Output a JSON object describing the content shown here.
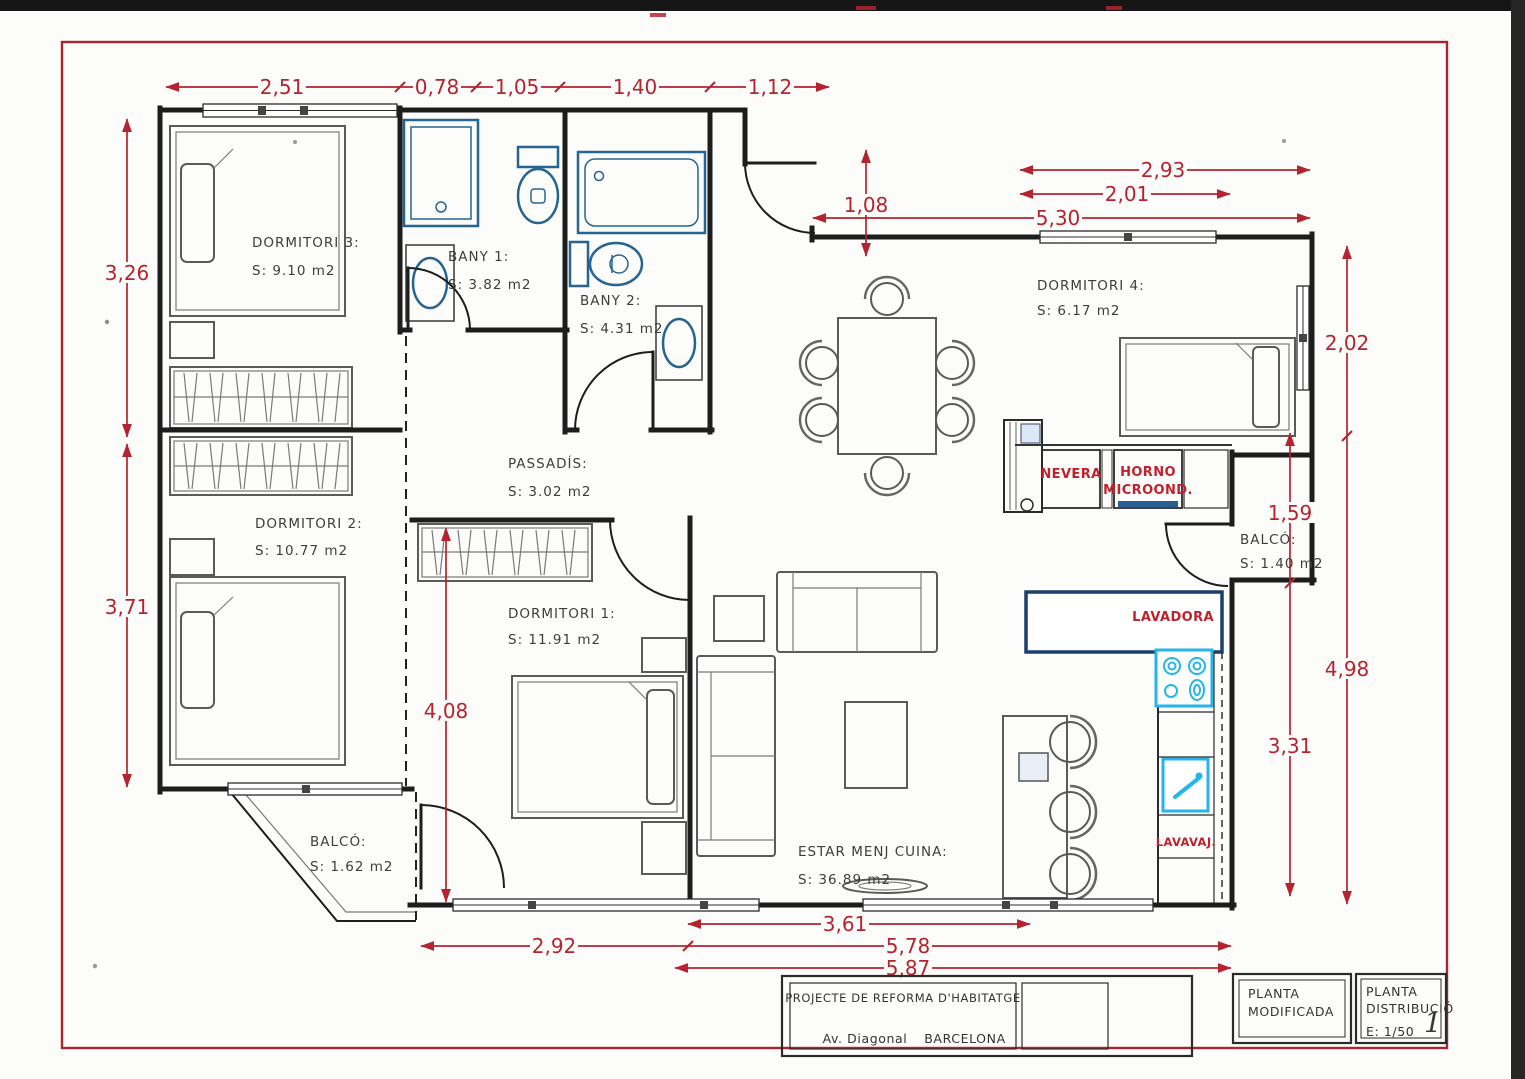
{
  "rooms": {
    "d3": {
      "name": "DORMITORI 3:",
      "area": "S: 9.10 m2"
    },
    "bany1": {
      "name": "BANY 1:",
      "area": "S: 3.82 m2"
    },
    "bany2": {
      "name": "BANY 2:",
      "area": "S: 4.31 m2"
    },
    "d4": {
      "name": "DORMITORI 4:",
      "area": "S: 6.17 m2"
    },
    "passadis": {
      "name": "PASSADÍS:",
      "area": "S: 3.02 m2"
    },
    "d2": {
      "name": "DORMITORI 2:",
      "area": "S: 10.77 m2"
    },
    "d1": {
      "name": "DORMITORI 1:",
      "area": "S: 11.91 m2"
    },
    "balco_r": {
      "name": "BALCÓ:",
      "area": "S: 1.40 m2"
    },
    "balco_l": {
      "name": "BALCÓ:",
      "area": "S: 1.62 m2"
    },
    "estar": {
      "name": "ESTAR MENJ CUINA:",
      "area": "S: 36.89 m2"
    }
  },
  "appliances": {
    "nevera": "NEVERA",
    "horno_1": "HORNO",
    "horno_2": "MICROOND.",
    "lavadora": "LAVADORA",
    "lavavaj": "LAVAVAJ."
  },
  "dims": {
    "top": [
      "2,51",
      "0,78",
      "1,05",
      "1,40",
      "1,12"
    ],
    "left": [
      "3,26",
      "3,71"
    ],
    "d1_height": "4,08",
    "entry": "1,08",
    "right_top": [
      "2,93",
      "2,01",
      "5,30"
    ],
    "right_col_a": [
      "2,02",
      "4,98"
    ],
    "right_col_b": [
      "1,59",
      "3,31"
    ],
    "bottom": [
      "3,61",
      "2,92",
      "5,78",
      "5,87"
    ]
  },
  "title_block": {
    "project": "PROJECTE  DE REFORMA D'HABITATGE",
    "street": "Av. Diagonal",
    "city": "BARCELONA",
    "sheet_type_1": "PLANTA",
    "sheet_type_2": "MODIFICADA",
    "sheet_name_1": "PLANTA",
    "sheet_name_2": "DISTRIBUCIÓ",
    "scale": "E: 1/50",
    "sheet_number": "1"
  },
  "colors": {
    "dimension_red": "#b5232e",
    "fixture_blue": "#27648f",
    "appliance_cyan": "#25b5e8",
    "counter_navy": "#1c3e6e",
    "wall_black": "#1d1d1d"
  }
}
